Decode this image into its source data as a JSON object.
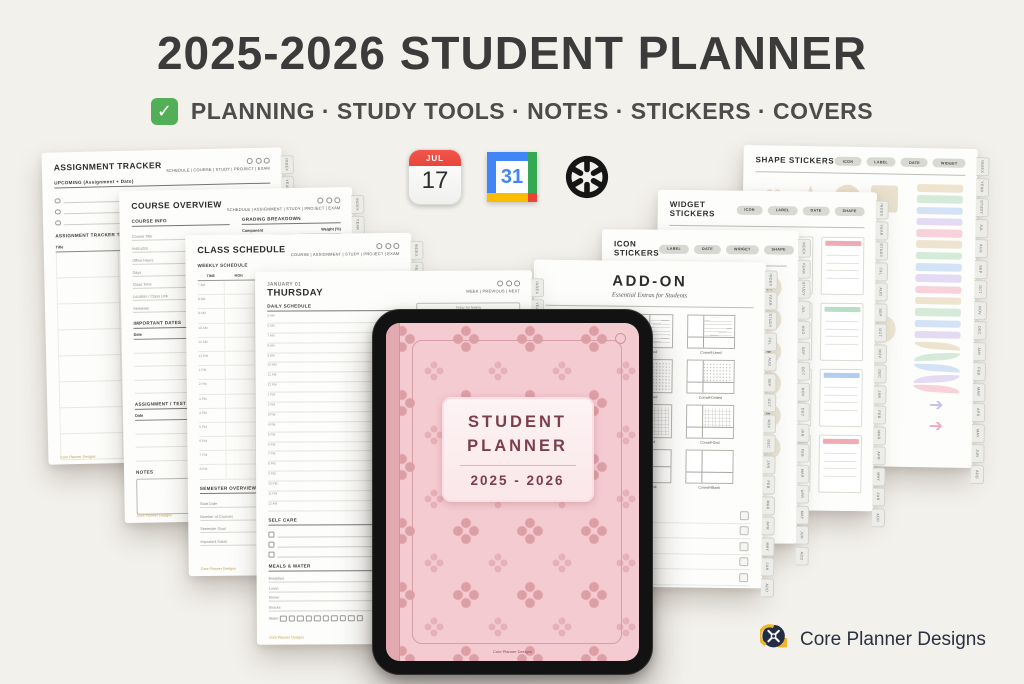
{
  "header": {
    "title": "2025-2026 STUDENT PLANNER",
    "subtitle": "PLANNING · STUDY TOOLS · NOTES · STICKERS · COVERS",
    "check_glyph": "✓",
    "check_color": "#52ae57"
  },
  "app_icons": {
    "apple_calendar": {
      "month": "JUL",
      "day": "17"
    },
    "google_calendar": {
      "day": "31"
    }
  },
  "side_tabs": [
    "INDEX",
    "YEAR",
    "STUDY",
    "JUL",
    "AUG",
    "SEP",
    "OCT",
    "NOV",
    "DEC",
    "JAN",
    "FEB",
    "MAR",
    "APR",
    "MAY",
    "JUN",
    "ADD"
  ],
  "pages": {
    "assignment_tracker": {
      "title": "ASSIGNMENT TRACKER",
      "nav": "SCHEDULE | COURSE | STUDY | PROJECT | EXAM",
      "upcoming_label": "UPCOMING (Assignment + Date)",
      "table_label": "ASSIGNMENT TRACKER TABLE",
      "col_title": "Title"
    },
    "course_overview": {
      "title": "COURSE OVERVIEW",
      "nav": "SCHEDULE | ASSIGNMENT | STUDY | PROJECT | EXAM",
      "course_info_label": "COURSE INFO",
      "fields": [
        "Course Title",
        "Instructor",
        "Office Hours",
        "Days",
        "Class Time",
        "Location / Class Link",
        "Semester"
      ],
      "grading_label": "GRADING BREAKDOWN",
      "grading_cols": [
        "Component",
        "Weight (%)"
      ],
      "dates_label": "IMPORTANT DATES",
      "dates_cols": [
        "Date",
        "Description"
      ],
      "log_label": "ASSIGNMENT / TEST LOG",
      "log_cols": [
        "Date",
        "Task / Test Name"
      ],
      "notes_label": "NOTES"
    },
    "class_schedule": {
      "title": "CLASS SCHEDULE",
      "nav": "COURSE | ASSIGNMENT | STUDY | PROJECT | EXAM",
      "weekly_label": "WEEKLY SCHEDULE",
      "cols": [
        "TIME",
        "MON",
        "TUE",
        "WED",
        "THU",
        "FRI",
        "SAT"
      ],
      "times": [
        "7 AM",
        "8 AM",
        "9 AM",
        "10 AM",
        "11 AM",
        "12 PM",
        "1 PM",
        "2 PM",
        "3 PM",
        "4 PM",
        "5 PM",
        "6 PM",
        "7 PM",
        "8 PM"
      ],
      "semester_label": "SEMESTER OVERVIEW",
      "semester_rows": [
        [
          "Start Date",
          "End Date"
        ],
        [
          "Number of Courses",
          "Total Credits"
        ],
        [
          "Semester Goal",
          ""
        ],
        [
          "Important Dates",
          ""
        ]
      ]
    },
    "daily": {
      "date": "JANUARY 01",
      "day": "THURSDAY",
      "nav": "WEEK | PREVIOUS | NEXT",
      "schedule_label": "DAILY SCHEDULE",
      "times": [
        "5 AM",
        "6 AM",
        "7 AM",
        "8 AM",
        "9 AM",
        "10 AM",
        "11 AM",
        "12 PM",
        "1 PM",
        "2 PM",
        "3 PM",
        "4 PM",
        "5 PM",
        "6 PM",
        "7 PM",
        "8 PM",
        "9 PM",
        "10 PM",
        "11 PM",
        "12 AM"
      ],
      "feeling_label": "Today I'm feeling",
      "selfcare_label": "SELF CARE",
      "meals_label": "MEALS & WATER",
      "meals": [
        "Breakfast",
        "Lunch",
        "Dinner",
        "Snacks"
      ],
      "water_label": "Water"
    },
    "addon": {
      "title": "ADD-ON",
      "subtitle": "Essential Extras for Students",
      "templates": [
        {
          "label": "",
          "kind": "lined"
        },
        {
          "label": "Half-Lined",
          "kind": "half-lined"
        },
        {
          "label": "Cornell-Lined",
          "kind": "cornell-lined"
        },
        {
          "label": "",
          "kind": "dotted"
        },
        {
          "label": "Half-Dotted",
          "kind": "half-dotted"
        },
        {
          "label": "Cornell-Dotted",
          "kind": "cornell-dotted"
        },
        {
          "label": "",
          "kind": "grid"
        },
        {
          "label": "Half-Grid",
          "kind": "half-grid"
        },
        {
          "label": "Cornell-Grid",
          "kind": "cornell-grid"
        },
        {
          "label": "",
          "kind": "blank"
        },
        {
          "label": "Quad-Blank",
          "kind": "quad"
        },
        {
          "label": "Cornell-Blank",
          "kind": "cornell-blank"
        }
      ],
      "covers_label": "COVERS",
      "covers": [
        {
          "name": "Blue Horizon Cover",
          "color": "#4d82d8"
        },
        {
          "name": "Lilac Whisper Cover",
          "color": "#c9b5e6"
        },
        {
          "name": "Blush Harmony Cover",
          "color": "#e6a7b5"
        },
        {
          "name": "Beige Blossom Cover",
          "color": "#ecd19e"
        },
        {
          "name": "Summer Mint Cover",
          "color": "#72c39c"
        }
      ]
    },
    "icon_stickers": {
      "title": "ICON STICKERS",
      "pills": [
        "LABEL",
        "DATE",
        "WIDGET",
        "SHAPE"
      ],
      "icons": [
        {
          "name": "pencil-icon",
          "glyph": "✎"
        },
        {
          "name": "envelope-icon",
          "glyph": "✉"
        },
        {
          "name": "home-icon",
          "glyph": "⌂"
        },
        {
          "name": "cloud-icon",
          "glyph": "☁"
        },
        {
          "name": "star-icon",
          "glyph": "★"
        },
        {
          "name": "music-note-icon",
          "glyph": "♪"
        },
        {
          "name": "coffee-icon",
          "glyph": "☕"
        },
        {
          "name": "plane-icon",
          "glyph": "✈"
        },
        {
          "name": "sun-icon",
          "glyph": "☼"
        },
        {
          "name": "umbrella-icon",
          "glyph": "☂"
        },
        {
          "name": "scissors-icon",
          "glyph": "✂"
        },
        {
          "name": "flag-icon",
          "glyph": "⚑"
        },
        {
          "name": "smiley-icon",
          "glyph": "☺"
        },
        {
          "name": "flower-icon",
          "glyph": "✿"
        },
        {
          "name": "heart-icon",
          "glyph": "♥"
        },
        {
          "name": "hourglass-icon",
          "glyph": "⌛"
        },
        {
          "name": "phone-icon",
          "glyph": "☎"
        },
        {
          "name": "plus-icon",
          "glyph": "✚"
        },
        {
          "name": "snowflake-icon",
          "glyph": "❄"
        },
        {
          "name": "check-icon",
          "glyph": "✔"
        },
        {
          "name": "moon-icon",
          "glyph": "☾"
        },
        {
          "name": "anchor-icon",
          "glyph": "⚓"
        },
        {
          "name": "blossom-icon",
          "glyph": "❀"
        },
        {
          "name": "sparkle-icon",
          "glyph": "✦"
        },
        {
          "name": "music-notes-icon",
          "glyph": "♬"
        },
        {
          "name": "yin-yang-icon",
          "glyph": "☯"
        },
        {
          "name": "gear-icon",
          "glyph": "⚙"
        },
        {
          "name": "list-icon",
          "glyph": "☰"
        },
        {
          "name": "cross-icon",
          "glyph": "✖"
        },
        {
          "name": "diamond-icon",
          "glyph": "◆"
        }
      ]
    },
    "widget_stickers": {
      "title": "WIDGET STICKERS",
      "pills": [
        "ICON",
        "LABEL",
        "DATE",
        "SHAPE"
      ],
      "cards": [
        "#b9ddc6",
        "#b3cdf2",
        "#cfc3ef",
        "#f0aab2",
        "#f6da96",
        "#b3cdf2",
        "#f0aab2",
        "#b9ddc6",
        "#f6da96",
        "#cfc3ef",
        "#f0aab2",
        "#b3cdf2",
        "#f6da96",
        "#b9ddc6",
        "#cfc3ef",
        "#f0aab2"
      ]
    },
    "shape_stickers": {
      "title": "SHAPE STICKERS",
      "pills": [
        "ICON",
        "LABEL",
        "DATE",
        "WIDGET"
      ],
      "shapes": [
        {
          "name": "heart",
          "glyph": "♥"
        },
        {
          "name": "star",
          "glyph": "★"
        },
        {
          "name": "circle",
          "glyph": ""
        },
        {
          "name": "square",
          "glyph": ""
        },
        {
          "name": "round",
          "glyph": ""
        },
        {
          "name": "rounded-square",
          "glyph": ""
        },
        {
          "name": "arch",
          "glyph": ""
        },
        {
          "name": "pill",
          "glyph": ""
        }
      ],
      "bars": [
        "#eee3cf",
        "#d5ead9",
        "#d4e2f6",
        "#e3daf4",
        "#f7d2da",
        "#eee3cf",
        "#d5ead9",
        "#d4e2f6",
        "#e3daf4",
        "#f7d2da",
        "#eee3cf",
        "#d5ead9",
        "#d4e2f6",
        "#e3daf4"
      ],
      "ribbons": [
        "#eee3cf",
        "#d5ead9",
        "#d4e2f6",
        "#e3daf4",
        "#f7d2da"
      ],
      "arrows": [
        {
          "color": "#c9bcf0",
          "glyph": "➔"
        },
        {
          "color": "#f5a9bd",
          "glyph": "➔"
        }
      ]
    }
  },
  "tablet": {
    "cover_line1": "STUDENT",
    "cover_line2": "PLANNER",
    "cover_years": "2025 - 2026"
  },
  "brand": {
    "name": "Core Planner Designs"
  }
}
